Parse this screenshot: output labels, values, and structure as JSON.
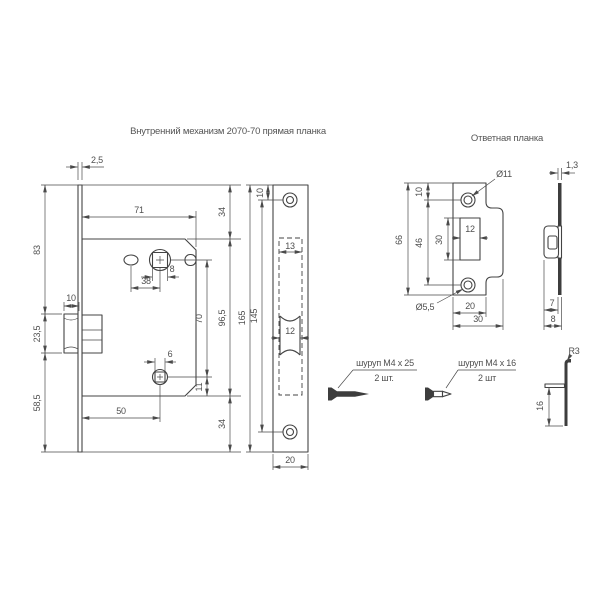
{
  "titles": {
    "mechanism": "Внутренний механизм 2070-70 прямая планка",
    "strike": "Ответная планка"
  },
  "colors": {
    "background": "#ffffff",
    "line": "#434343",
    "text": "#4f4f4f"
  },
  "mechanism_view": {
    "plate_thickness": "2,5",
    "body_width": "71",
    "upper_height": "83",
    "latch_width": "10",
    "latch_height": "23,5",
    "lower_height": "58,5",
    "spindle_square": "8",
    "hole_spacing": "38",
    "bottom_square": "6",
    "backset": "50",
    "spindle_to_square": "70",
    "square_to_edge": "11",
    "top_offset": "34",
    "body_height": "96,5",
    "bottom_offset": "34"
  },
  "faceplate_view": {
    "top_hole_offset": "10",
    "total_height": "165",
    "hole_spacing": "145",
    "body_width": "13",
    "latch_width": "12",
    "plate_width": "20"
  },
  "strike_view": {
    "hole_diameter": "Ø11",
    "top_hole_offset": "10",
    "total_height": "66",
    "hole_spacing": "46",
    "slot_height": "30",
    "slot_width": "12",
    "screw_hole_diameter": "Ø5,5",
    "plate_width": "20",
    "total_width": "30"
  },
  "strike_side_view": {
    "thickness": "1,3",
    "lip_offset": "7",
    "lip_depth": "8",
    "lip_radius": "R3",
    "lip_height": "16"
  },
  "screws": {
    "mechanism_screw": {
      "label": "шуруп М4 x 25",
      "quantity": "2 шт."
    },
    "strike_screw": {
      "label": "шуруп М4 x 16",
      "quantity": "2 шт"
    }
  }
}
